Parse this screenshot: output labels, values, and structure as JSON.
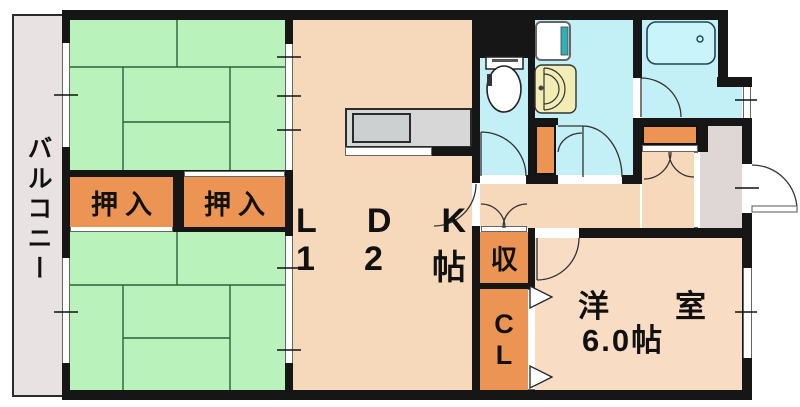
{
  "labels": {
    "balcony": "バルコニー",
    "oshiire_left": "押入",
    "oshiire_right": "押入",
    "ldk_name": [
      "L",
      "D",
      "K"
    ],
    "ldk_size": [
      "1",
      "2",
      "帖"
    ],
    "storage": "収",
    "closet": [
      "C",
      "L"
    ],
    "western_name": [
      "洋",
      "室"
    ],
    "western_size": "6.0帖"
  },
  "fixtures": [
    "toilet",
    "washing-machine",
    "vanity-sink",
    "bathtub",
    "kitchen-counter",
    "kitchen-sink"
  ],
  "colors": {
    "tatami": "#b9f2ba",
    "tatami_line": "#2e5f3a",
    "floor": "#f6d8ba",
    "floor_light": "#f8dcc3",
    "closet_orange": "#ec9454",
    "wet_cyan": "#c3f0f6",
    "tub_cyan": "#c9f4f9",
    "vanity_cream": "#f2edb4",
    "balcony_gray": "#e8e3e2",
    "entrance_gray": "#ded7d6",
    "counter_gray": "#d7d7d7",
    "wall": "#161616",
    "text": "#111111",
    "accent_teal": "#2fb0b5"
  }
}
